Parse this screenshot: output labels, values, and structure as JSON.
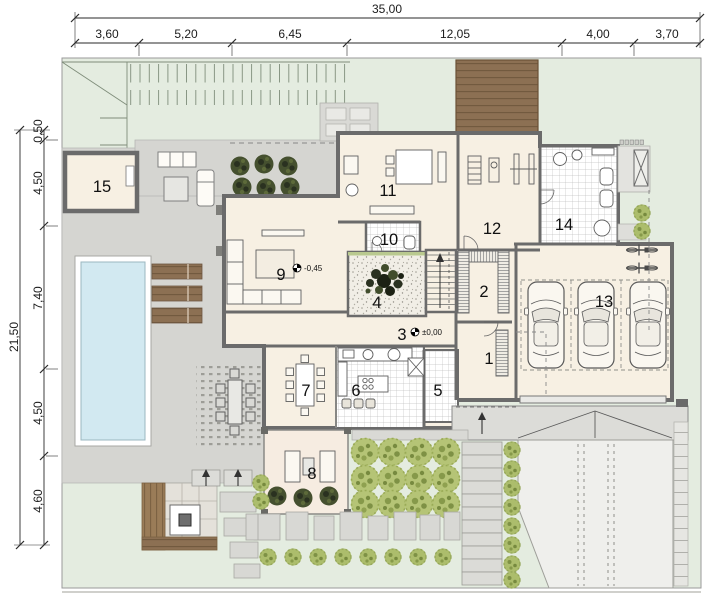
{
  "dims_top": {
    "total": "35,00",
    "segments": [
      "3,60",
      "5,20",
      "6,45",
      "12,05",
      "4,00",
      "3,70"
    ]
  },
  "dims_left": {
    "total": "21,50",
    "segments": [
      "0,50",
      "4,50",
      "7,40",
      "4,50",
      "4,60"
    ]
  },
  "rooms": {
    "r1": "1",
    "r2": "2",
    "r3": "3",
    "r4": "4",
    "r5": "5",
    "r6": "6",
    "r7": "7",
    "r8": "8",
    "r9": "9",
    "r10": "10",
    "r11": "11",
    "r12": "12",
    "r13": "13",
    "r14": "14",
    "r15": "15"
  },
  "levels": {
    "living": "-0,45",
    "hall": "±0,00"
  },
  "colors": {
    "lawn": "#e4ece0",
    "paving": "#d5d5d1",
    "floor": "#f7f0e3",
    "wall": "#6b6b6b",
    "pool_water": "#d2e9f1",
    "wood_deck": "#8c7053",
    "tree_green": "#b5c476",
    "dark_plant": "#45502f",
    "driveway": "#efefec",
    "tile_line": "#c2c2c2"
  }
}
